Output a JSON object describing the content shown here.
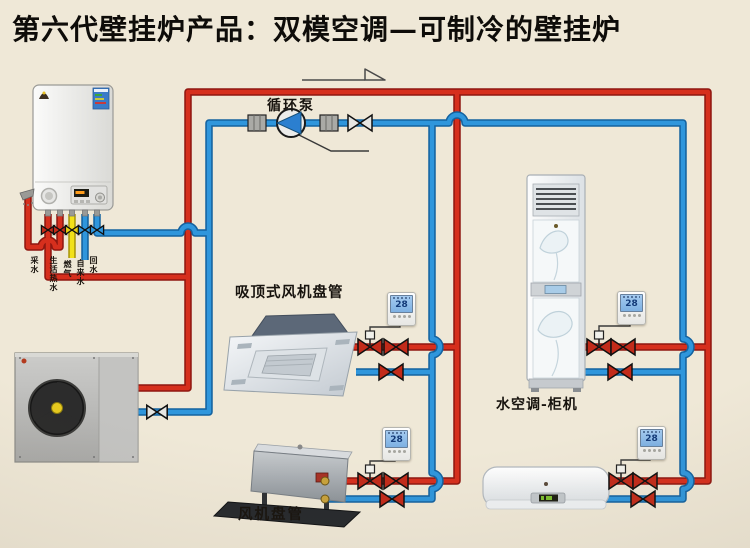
{
  "title": "第六代壁挂炉产品：双模空调—可制冷的壁挂炉",
  "labels": {
    "pump": "循环泵",
    "cassette": "吸顶式风机盘管",
    "floor": "水空调-柜机",
    "ducted": "风机盘管"
  },
  "boiler_ports": [
    {
      "label": "采水",
      "type": "hot"
    },
    {
      "label": "生活热水",
      "type": "hot"
    },
    {
      "label": "燃气",
      "type": "gas"
    },
    {
      "label": "自来水",
      "type": "cold"
    },
    {
      "label": "回水",
      "type": "cold"
    }
  ],
  "thermostats": [
    {
      "unit": "cassette",
      "value": "28"
    },
    {
      "unit": "floor",
      "value": "28"
    },
    {
      "unit": "ducted",
      "value": "28"
    },
    {
      "unit": "wall",
      "value": "28"
    }
  ],
  "colors": {
    "background": "#efe8d7",
    "hot_pipe": "#d62f1d",
    "cold_pipe": "#2f96dc",
    "gas_pipe": "#f2e118"
  }
}
